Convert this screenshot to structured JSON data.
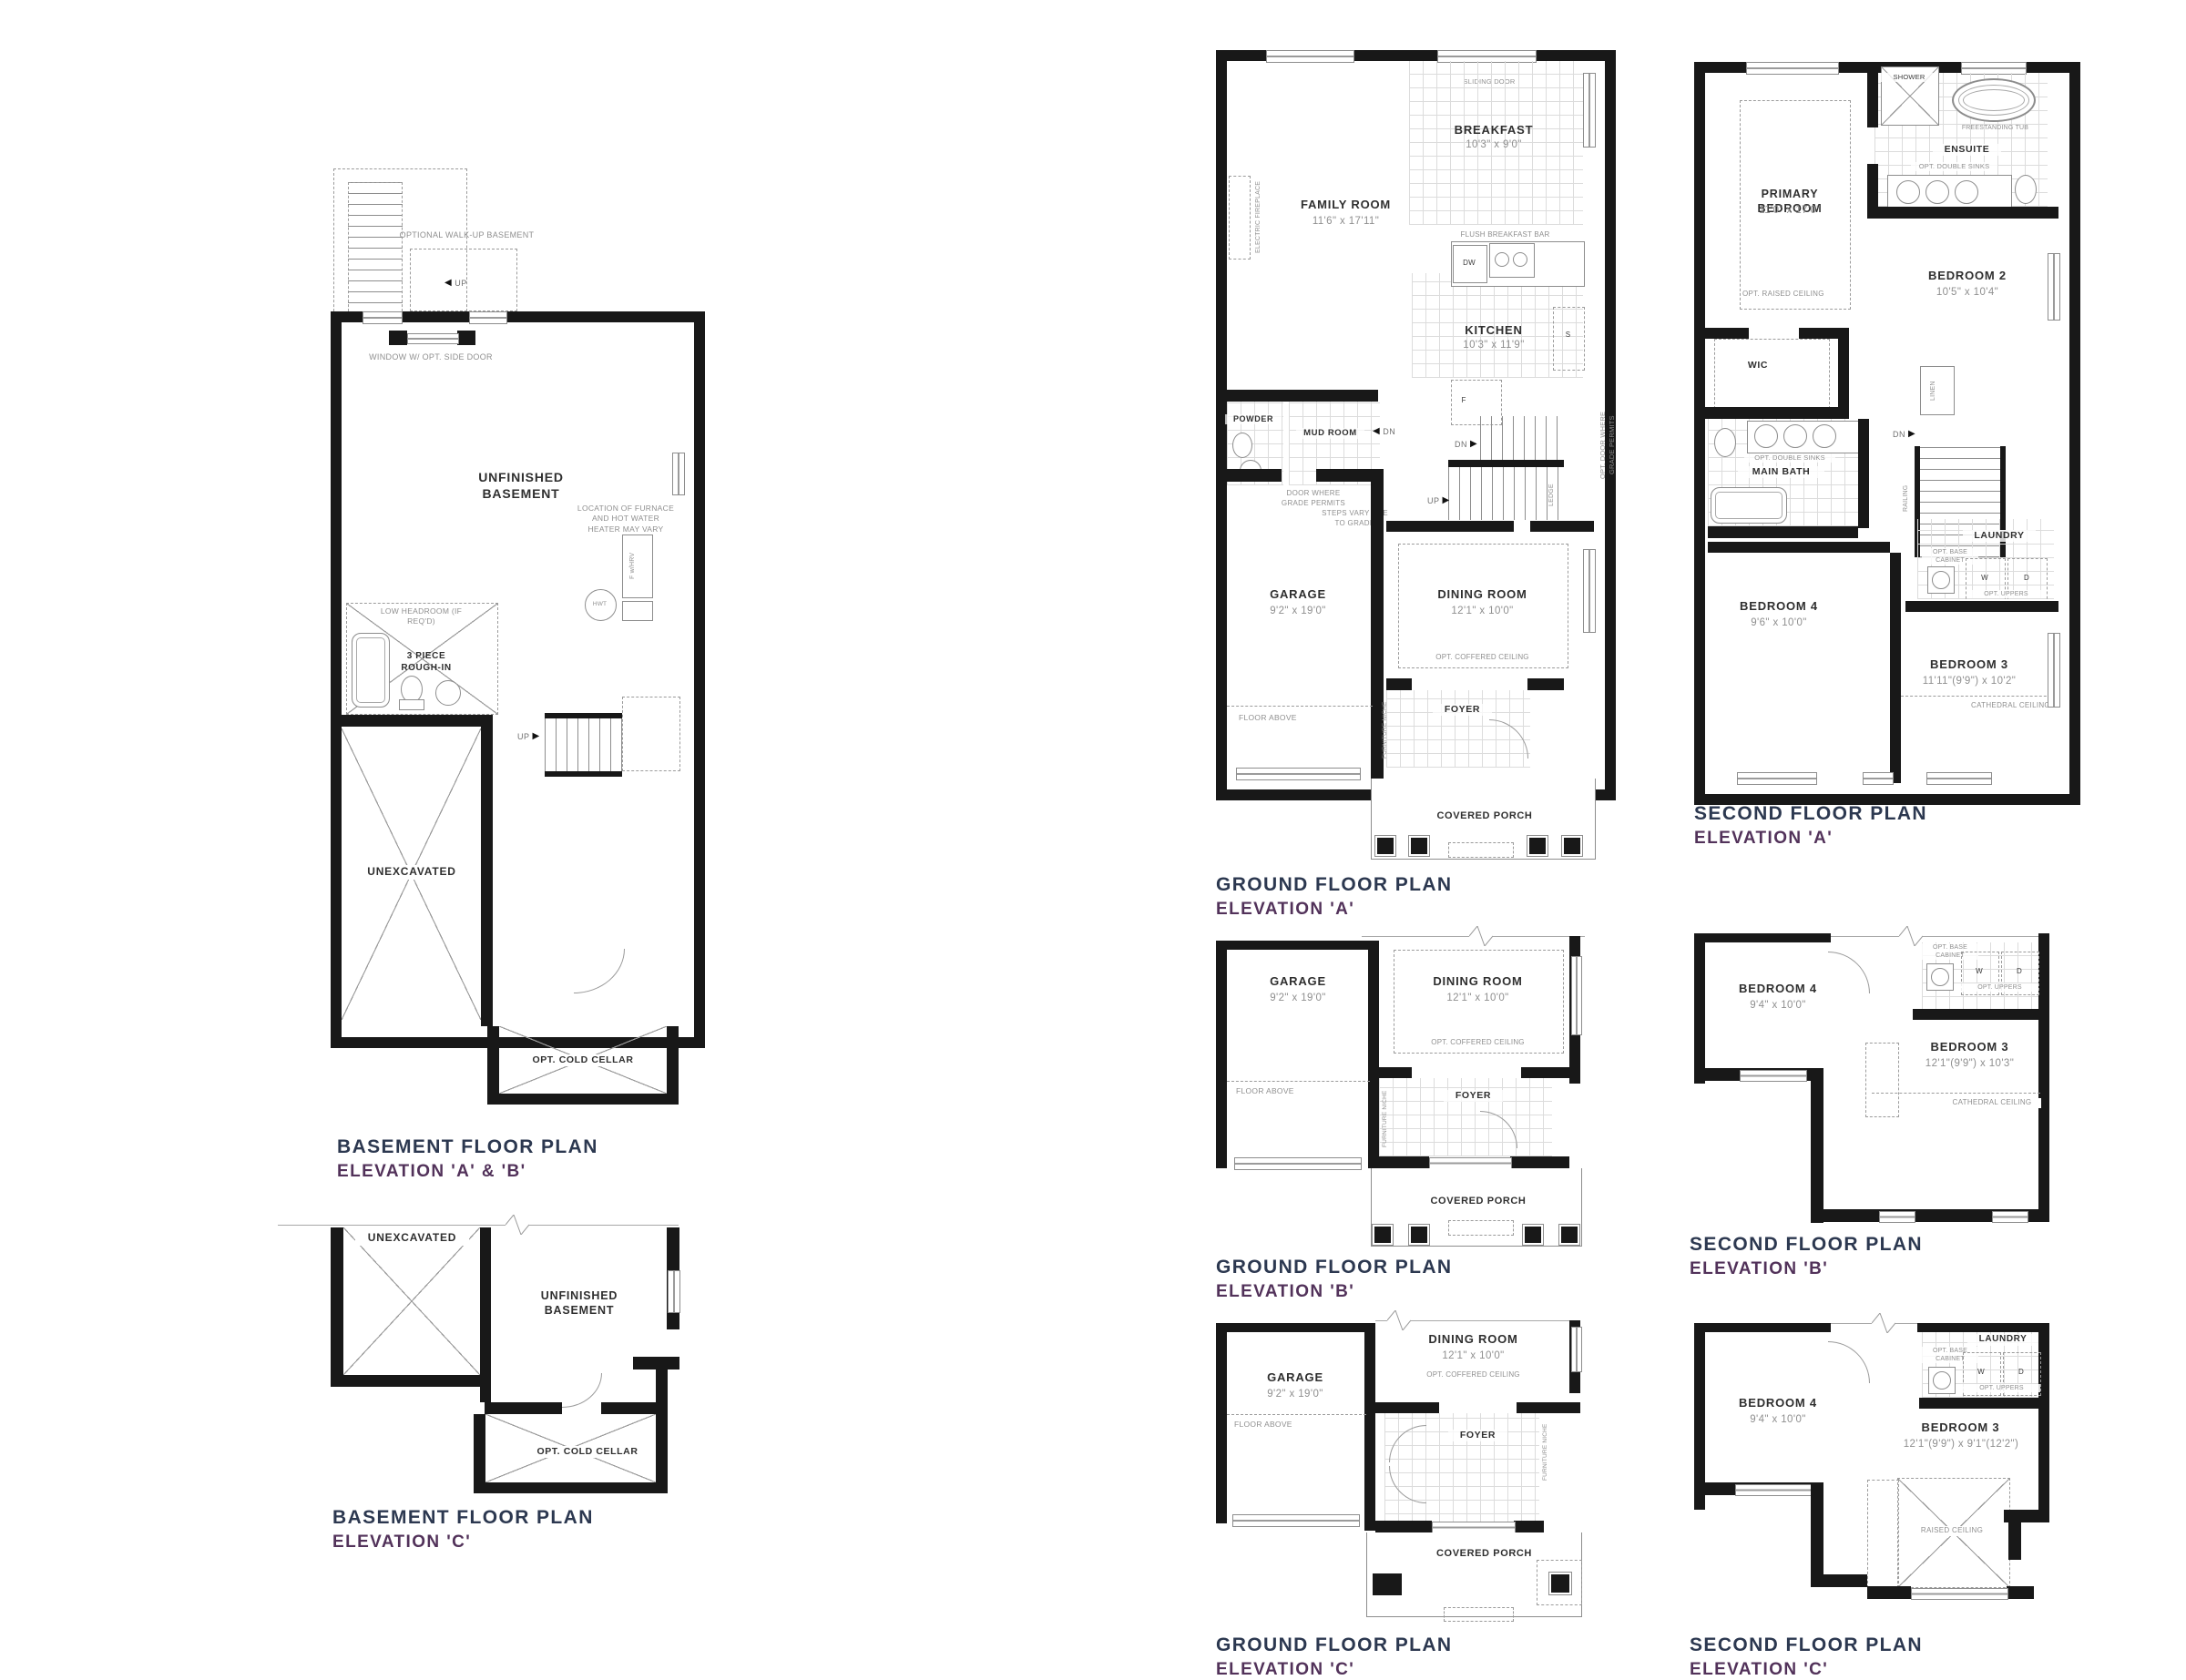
{
  "document": {
    "type": "architectural floor plan sheet"
  },
  "colors": {
    "title_navy": "#2c3850",
    "subtitle_purple": "#52325a",
    "wall_black": "#181818",
    "line_gray": "#8d8d8d"
  },
  "plans": {
    "basement_ab": {
      "title": "BASEMENT FLOOR PLAN",
      "subtitle": "ELEVATION 'A' & 'B'",
      "labels": {
        "walkup": "OPTIONAL WALK-UP BASEMENT",
        "up": "UP",
        "window_side_door": "WINDOW W/ OPT. SIDE DOOR",
        "unfinished": "UNFINISHED BASEMENT",
        "furnace_note": "LOCATION OF FURNACE AND HOT WATER HEATER MAY VARY",
        "f_hrv": "F w/HRV",
        "hwt": "HWT",
        "low_headroom": "LOW HEADROOM (IF REQ'D)",
        "rough_in": "3 PIECE ROUGH-IN",
        "unexcavated": "UNEXCAVATED",
        "cold_cellar": "OPT. COLD CELLAR"
      }
    },
    "basement_c": {
      "title": "BASEMENT FLOOR PLAN",
      "subtitle": "ELEVATION 'C'",
      "labels": {
        "unexcavated": "UNEXCAVATED",
        "unfinished": "UNFINISHED BASEMENT",
        "cold_cellar": "OPT. COLD CELLAR"
      }
    },
    "ground_a": {
      "title": "GROUND FLOOR PLAN",
      "subtitle": "ELEVATION 'A'",
      "rooms": {
        "family": {
          "name": "FAMILY ROOM",
          "dims": "11'6\" x 17'11\""
        },
        "breakfast": {
          "name": "BREAKFAST",
          "dims": "10'3\" x 9'0\""
        },
        "kitchen": {
          "name": "KITCHEN",
          "dims": "10'3\" x 11'9\""
        },
        "garage": {
          "name": "GARAGE",
          "dims": "9'2\" x 19'0\""
        },
        "dining": {
          "name": "DINING ROOM",
          "dims": "12'1\" x 10'0\""
        }
      },
      "labels": {
        "sliding_door": "SLIDING DOOR",
        "electric_fireplace": "ELECTRIC FIREPLACE",
        "flush_bar": "FLUSH BREAKFAST BAR",
        "dw": "DW",
        "s": "S",
        "f": "F",
        "powder": "POWDER",
        "mud_room": "MUD ROOM",
        "dn": "DN",
        "up": "UP",
        "ledge": "LEDGE",
        "door_grade": "DOOR WHERE GRADE PERMITS",
        "steps_vary": "STEPS VARY DUE TO GRADE",
        "opt_door_grade": "OPT. DOOR WHERE GRADE PERMITS",
        "coffered": "OPT. COFFERED CEILING",
        "floor_above": "FLOOR ABOVE",
        "furniture_niche": "FURNITURE NICHE",
        "foyer": "FOYER",
        "porch": "COVERED PORCH"
      }
    },
    "ground_b": {
      "title": "GROUND FLOOR PLAN",
      "subtitle": "ELEVATION 'B'",
      "rooms": {
        "garage": {
          "name": "GARAGE",
          "dims": "9'2\" x 19'0\""
        },
        "dining": {
          "name": "DINING ROOM",
          "dims": "12'1\" x 10'0\""
        }
      },
      "labels": {
        "coffered": "OPT. COFFERED CEILING",
        "floor_above": "FLOOR ABOVE",
        "furniture_niche": "FURNITURE NICHE",
        "foyer": "FOYER",
        "porch": "COVERED PORCH"
      }
    },
    "ground_c": {
      "title": "GROUND FLOOR PLAN",
      "subtitle": "ELEVATION 'C'",
      "rooms": {
        "garage": {
          "name": "GARAGE",
          "dims": "9'2\" x 19'0\""
        },
        "dining": {
          "name": "DINING ROOM",
          "dims": "12'1\" x 10'0\""
        }
      },
      "labels": {
        "coffered": "OPT. COFFERED CEILING",
        "floor_above": "FLOOR ABOVE",
        "furniture_niche": "FURNITURE NICHE",
        "foyer": "FOYER",
        "porch": "COVERED PORCH"
      }
    },
    "second_a": {
      "title": "SECOND FLOOR PLAN",
      "subtitle": "ELEVATION 'A'",
      "rooms": {
        "primary": {
          "name": "PRIMARY BEDROOM",
          "dims": "11'0\" x 17'0\""
        },
        "bedroom2": {
          "name": "BEDROOM 2",
          "dims": "10'5\" x 10'4\""
        },
        "bedroom4": {
          "name": "BEDROOM 4",
          "dims": "9'6\" x 10'0\""
        },
        "bedroom3": {
          "name": "BEDROOM 3",
          "dims": "11'11\"(9'9\") x 10'2\""
        }
      },
      "labels": {
        "shower": "SHOWER",
        "tub": "FREESTANDING TUB",
        "ensuite": "ENSUITE",
        "double_sinks": "OPT. DOUBLE SINKS",
        "raised_ceiling": "OPT. RAISED CEILING",
        "wic": "WIC",
        "linen": "LINEN",
        "main_bath": "MAIN BATH",
        "dn": "DN",
        "railing": "RAILING",
        "laundry": "LAUNDRY",
        "base_cabinet": "OPT. BASE CABINET",
        "w": "W",
        "d": "D",
        "uppers": "OPT. UPPERS",
        "cathedral": "CATHEDRAL CEILING"
      }
    },
    "second_b": {
      "title": "SECOND FLOOR PLAN",
      "subtitle": "ELEVATION 'B'",
      "rooms": {
        "bedroom4": {
          "name": "BEDROOM 4",
          "dims": "9'4\" x 10'0\""
        },
        "bedroom3": {
          "name": "BEDROOM 3",
          "dims": "12'1\"(9'9\") x 10'3\""
        }
      },
      "labels": {
        "base_cabinet": "OPT. BASE CABINET",
        "w": "W",
        "d": "D",
        "uppers": "OPT. UPPERS",
        "cathedral": "CATHEDRAL CEILING"
      }
    },
    "second_c": {
      "title": "SECOND FLOOR PLAN",
      "subtitle": "ELEVATION 'C'",
      "rooms": {
        "bedroom4": {
          "name": "BEDROOM 4",
          "dims": "9'4\" x 10'0\""
        },
        "bedroom3": {
          "name": "BEDROOM 3",
          "dims": "12'1\"(9'9\") x 9'1\"(12'2\")"
        }
      },
      "labels": {
        "laundry": "LAUNDRY",
        "base_cabinet": "OPT. BASE CABINET",
        "w": "W",
        "d": "D",
        "uppers": "OPT. UPPERS",
        "raised_ceiling": "RAISED CEILING"
      }
    }
  }
}
